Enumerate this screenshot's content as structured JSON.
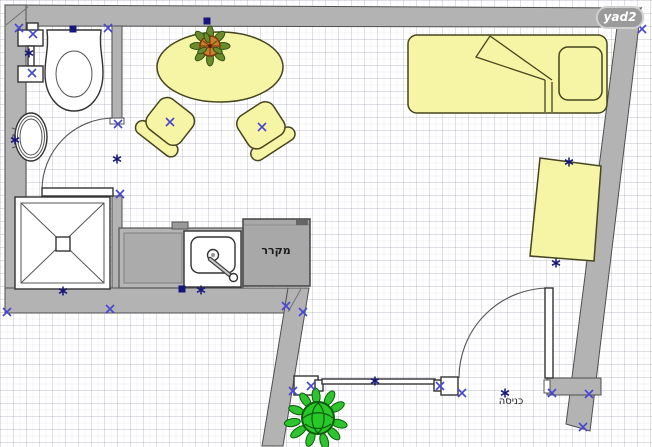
{
  "watermark": {
    "text": "yad2"
  },
  "labels": {
    "refrigerator": "מקרר",
    "entrance": "כניסה"
  },
  "colors": {
    "wall": "#b3b3b3",
    "wall_outline": "#4f4f4f",
    "furniture_fill": "#f6f4a5",
    "furniture_outline": "#45451f",
    "appliance_fill": "#a8a8a8",
    "fixture_fill": "#ffffff",
    "fixture_outline": "#333333",
    "selection_cross": "#4646d2",
    "selection_point": "#15157a",
    "plant_leaf": "#2dc42d",
    "plant_outline": "#0c5c0c",
    "pot_fill": "#c8802c",
    "pot_outline": "#7a3a10",
    "grid_line": "#d8dce4",
    "background": "#ffffff",
    "watermark_bg": "#9a9a9a",
    "watermark_text": "#ffffff"
  },
  "icons": {
    "fixtures": [
      "toilet-icon",
      "bathroom-sink-icon",
      "shower-icon",
      "kitchen-sink-icon",
      "refrigerator-icon",
      "dining-table-icon",
      "chair-icon",
      "bed-icon",
      "pillow-icon",
      "desk-icon",
      "potted-plant-icon",
      "door-swing-icon",
      "window-icon",
      "selection-x-icon",
      "selection-asterisk-icon",
      "selection-handle-icon"
    ]
  }
}
